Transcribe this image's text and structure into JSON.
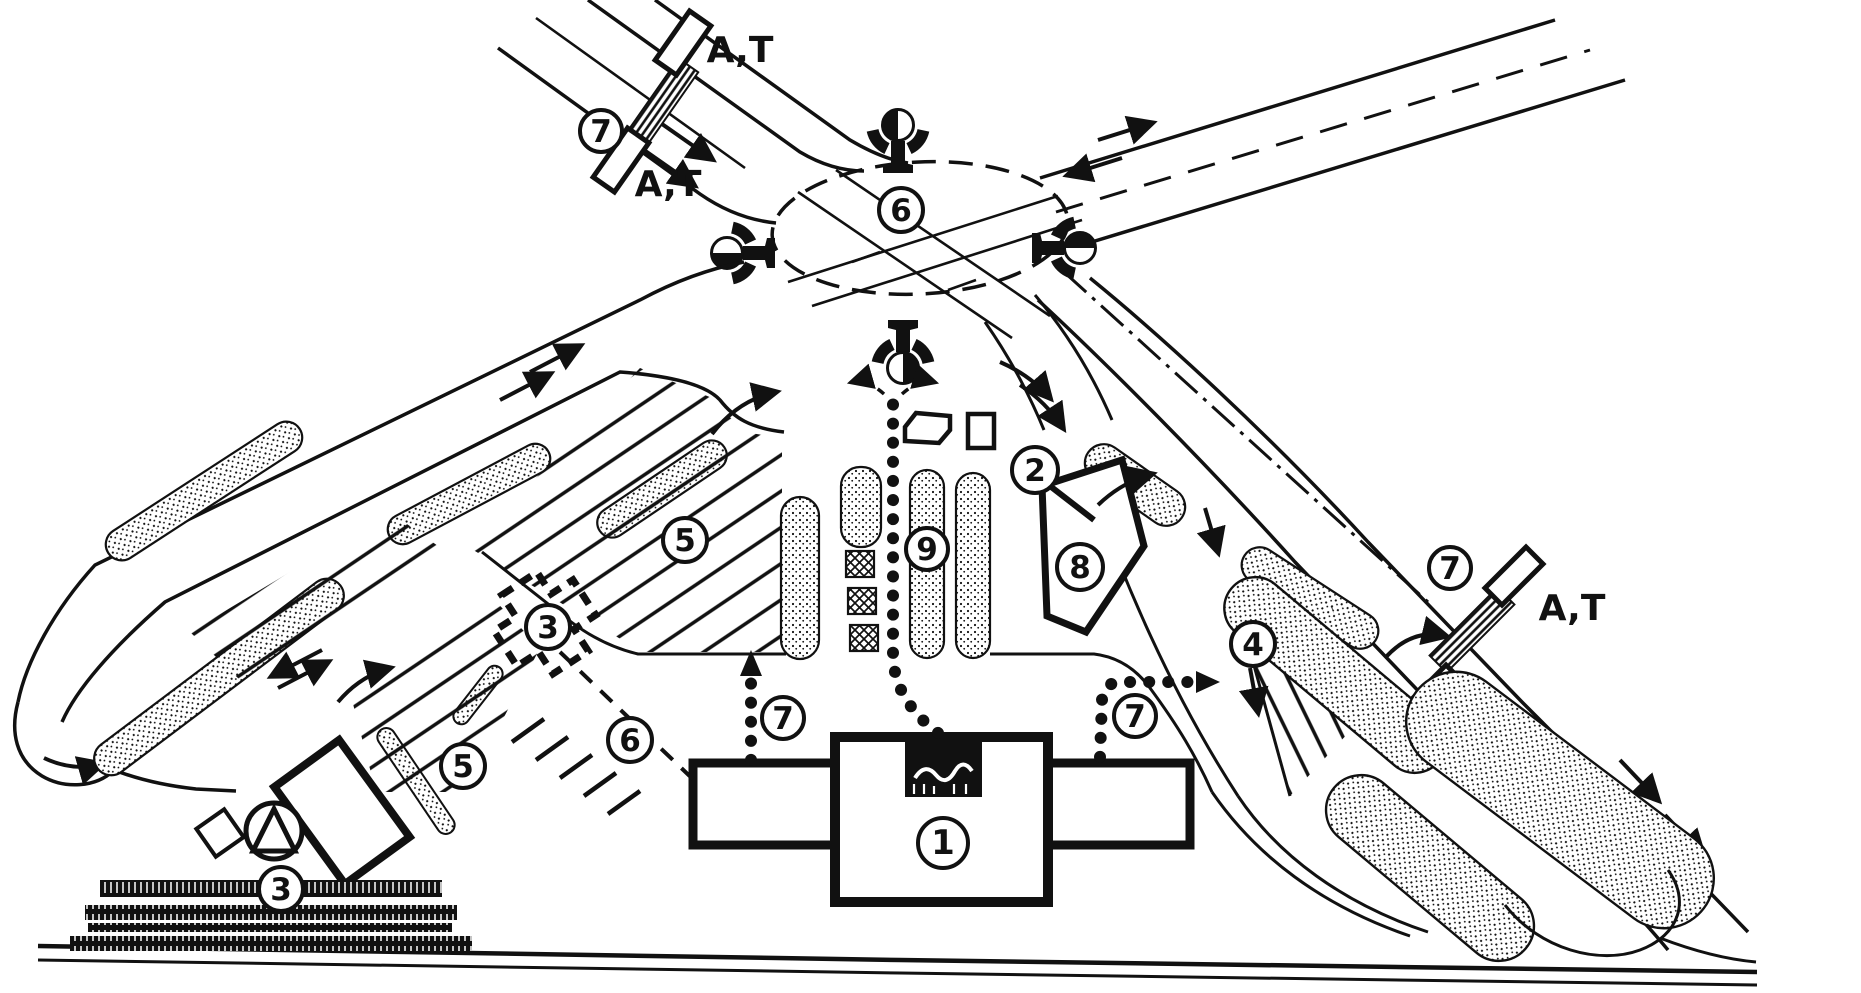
{
  "figure": {
    "kind": "motorway rest-area site plan, hand-drawn black ink schematic",
    "background": "#ffffff",
    "ink": "#111111"
  },
  "markers": {
    "building_main": "1",
    "access_to_fuel": "2",
    "annex_planned": "3",
    "truck_parking": "3",
    "coach_parking": "4",
    "car_parking_upper": "5",
    "car_parking_lower": "5",
    "junction_signals": "6",
    "annex_route": "6",
    "crossing_top_left": "7",
    "footpath_left": "7",
    "footpath_right": "7",
    "crossing_right": "7",
    "fuel_station": "8",
    "parking_island": "9"
  },
  "stop_labels": {
    "top_left_far": "A,T",
    "top_left_near": "A,T",
    "right_upper": "A,T",
    "right_lower": "A,T"
  }
}
